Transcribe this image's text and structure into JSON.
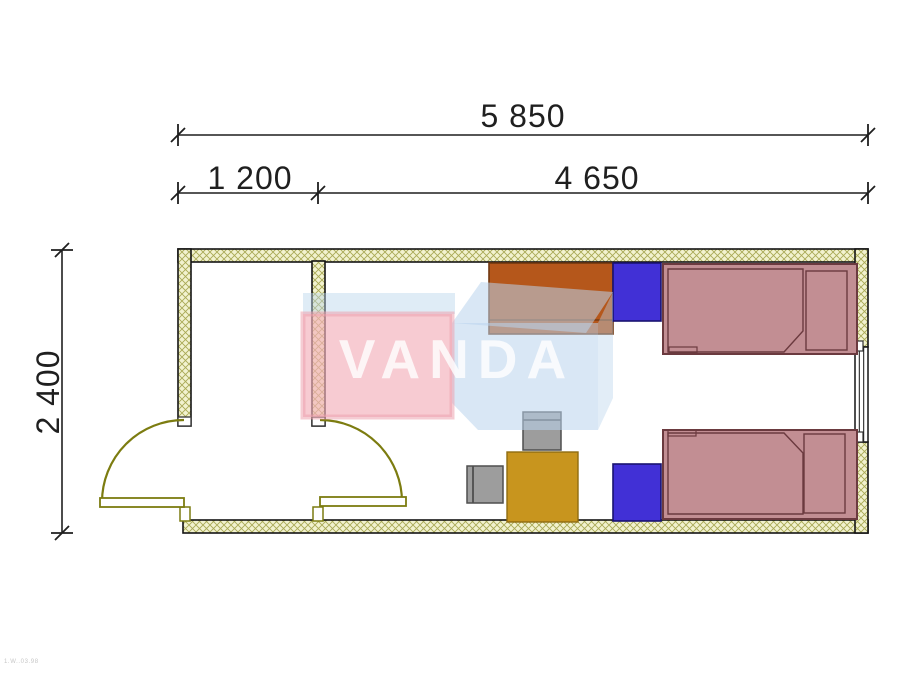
{
  "drawing": {
    "type": "floor-plan",
    "watermark_text": "VANDA",
    "corner_code": "1.W..03.98",
    "dimensions": {
      "total_width_mm": "5 850",
      "left_room_width_mm": "1 200",
      "main_room_width_mm": "4 650",
      "depth_mm": "2 400"
    },
    "furniture": [
      {
        "name": "desk-wardrobe",
        "color": "#b5571b"
      },
      {
        "name": "cabinet-top",
        "color": "#4130d6"
      },
      {
        "name": "bed-top",
        "color": "#c28e93"
      },
      {
        "name": "cabinet-bottom",
        "color": "#4130d6"
      },
      {
        "name": "bed-bottom",
        "color": "#c28e93"
      },
      {
        "name": "table",
        "color": "#c8951e"
      },
      {
        "name": "chair-top",
        "color": "#9d9d9d"
      },
      {
        "name": "chair-left",
        "color": "#9d9d9d"
      }
    ]
  },
  "colors": {
    "wall_bg": "#f2f2cf",
    "wall_hatch_line": "#a9a955",
    "wall_outline": "#141414",
    "door": "#7c7c10",
    "bed_fill": "#c28e93",
    "bed_outline": "#6b3a3f",
    "cabinet_fill": "#4130d6",
    "cabinet_outline": "#191370",
    "desk_fill": "#b5571b",
    "desk_outline": "#6f3711",
    "table_fill": "#c8951e",
    "table_outline": "#8f6c11",
    "chair_fill": "#9d9d9d",
    "chair_outline": "#4f4f4f",
    "dim_color": "#1f1f1f",
    "wm_pink": "#f3b0bb",
    "wm_pink_edge": "#eda2af",
    "wm_blue": "#b9d4ec",
    "wm_text": "#ffffff"
  }
}
